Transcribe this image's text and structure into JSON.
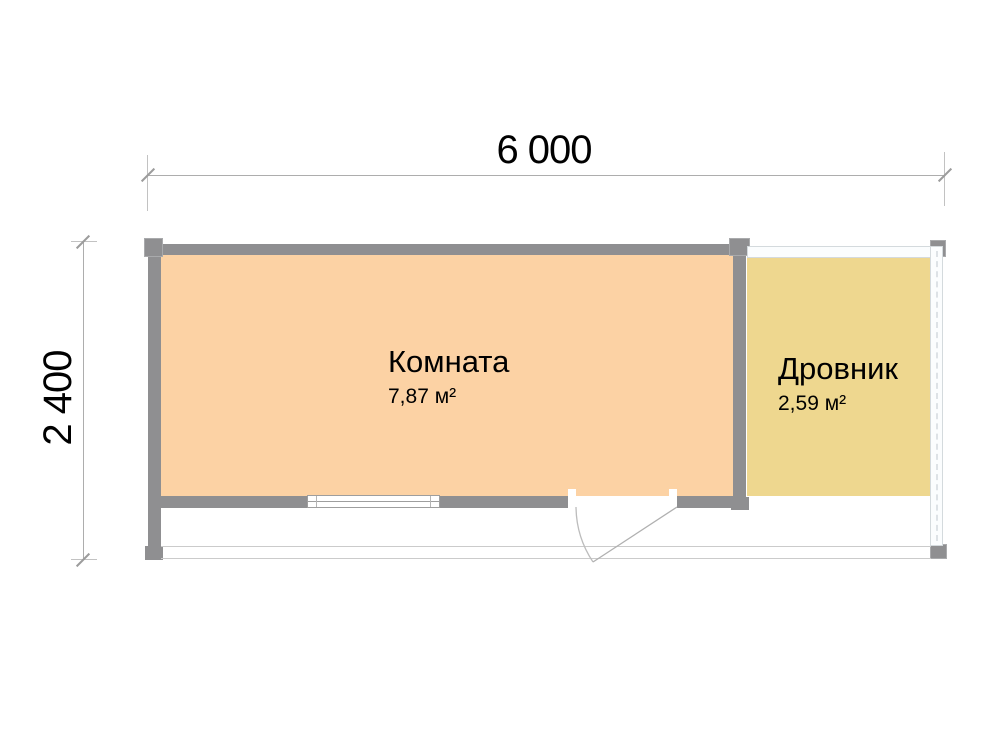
{
  "plan": {
    "dimensions": {
      "width": "6 000",
      "depth": "2 400"
    },
    "rooms": [
      {
        "name": "Комната",
        "area": "7,87 м²"
      },
      {
        "name": "Дровник",
        "area": "2,59 м²"
      }
    ],
    "colors": {
      "wall": "#8f8f91",
      "room_fill": "#fcd2a4",
      "shed_fill": "#eed78f",
      "open_wall": "#fbfdfe",
      "open_wall_border": "#d4dadd",
      "dimension_line": "#adadad",
      "text": "#000000"
    }
  }
}
